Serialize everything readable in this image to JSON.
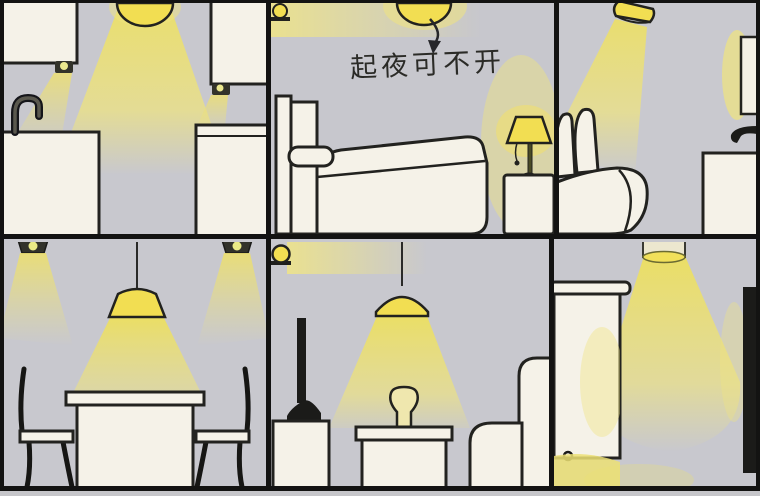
{
  "annotation": {
    "text": "起夜可不开"
  },
  "palette": {
    "wall": "#c8c8ce",
    "panel_border": "#131312",
    "beam_yellow": "#ece074",
    "lamp_yellow": "#f2de52",
    "furniture_white": "#f5f2e8",
    "outline": "#22221f",
    "fixture_dark": "#33332a"
  },
  "panels": [
    {
      "name": "kitchen",
      "lights": [
        "ceiling-dome-lamp",
        "under-cabinet-light-left",
        "under-cabinet-light-right"
      ],
      "furniture": [
        "wall-cabinet-left",
        "wall-cabinet-right",
        "gooseneck-faucet",
        "sink-counter",
        "base-cabinet"
      ]
    },
    {
      "name": "bedroom",
      "lights": [
        "ceiling-dome-lamp",
        "wall-lamp",
        "bedside-table-lamp"
      ],
      "furniture": [
        "headboard",
        "pillow",
        "bed",
        "nightstand"
      ],
      "annotation": "起夜可不开"
    },
    {
      "name": "bathroom",
      "lights": [
        "angled-cone-lamp",
        "mirror-backlight"
      ],
      "furniture": [
        "toilet-lid-up",
        "mirror",
        "wall-faucet",
        "vanity-cabinet"
      ]
    },
    {
      "name": "dining-room",
      "lights": [
        "recessed-downlight-left",
        "recessed-downlight-right",
        "pendant-lamp"
      ],
      "furniture": [
        "dining-table",
        "chair-left",
        "chair-right"
      ]
    },
    {
      "name": "living-room",
      "lights": [
        "wall-sconce",
        "pendant-dome-lamp"
      ],
      "furniture": [
        "tv",
        "tv-stand",
        "side-table",
        "vase",
        "sofa"
      ]
    },
    {
      "name": "hallway",
      "lights": [
        "ceiling-cylinder-downlight"
      ],
      "furniture": [
        "wardrobe-cabinet",
        "wall-screen"
      ]
    }
  ]
}
